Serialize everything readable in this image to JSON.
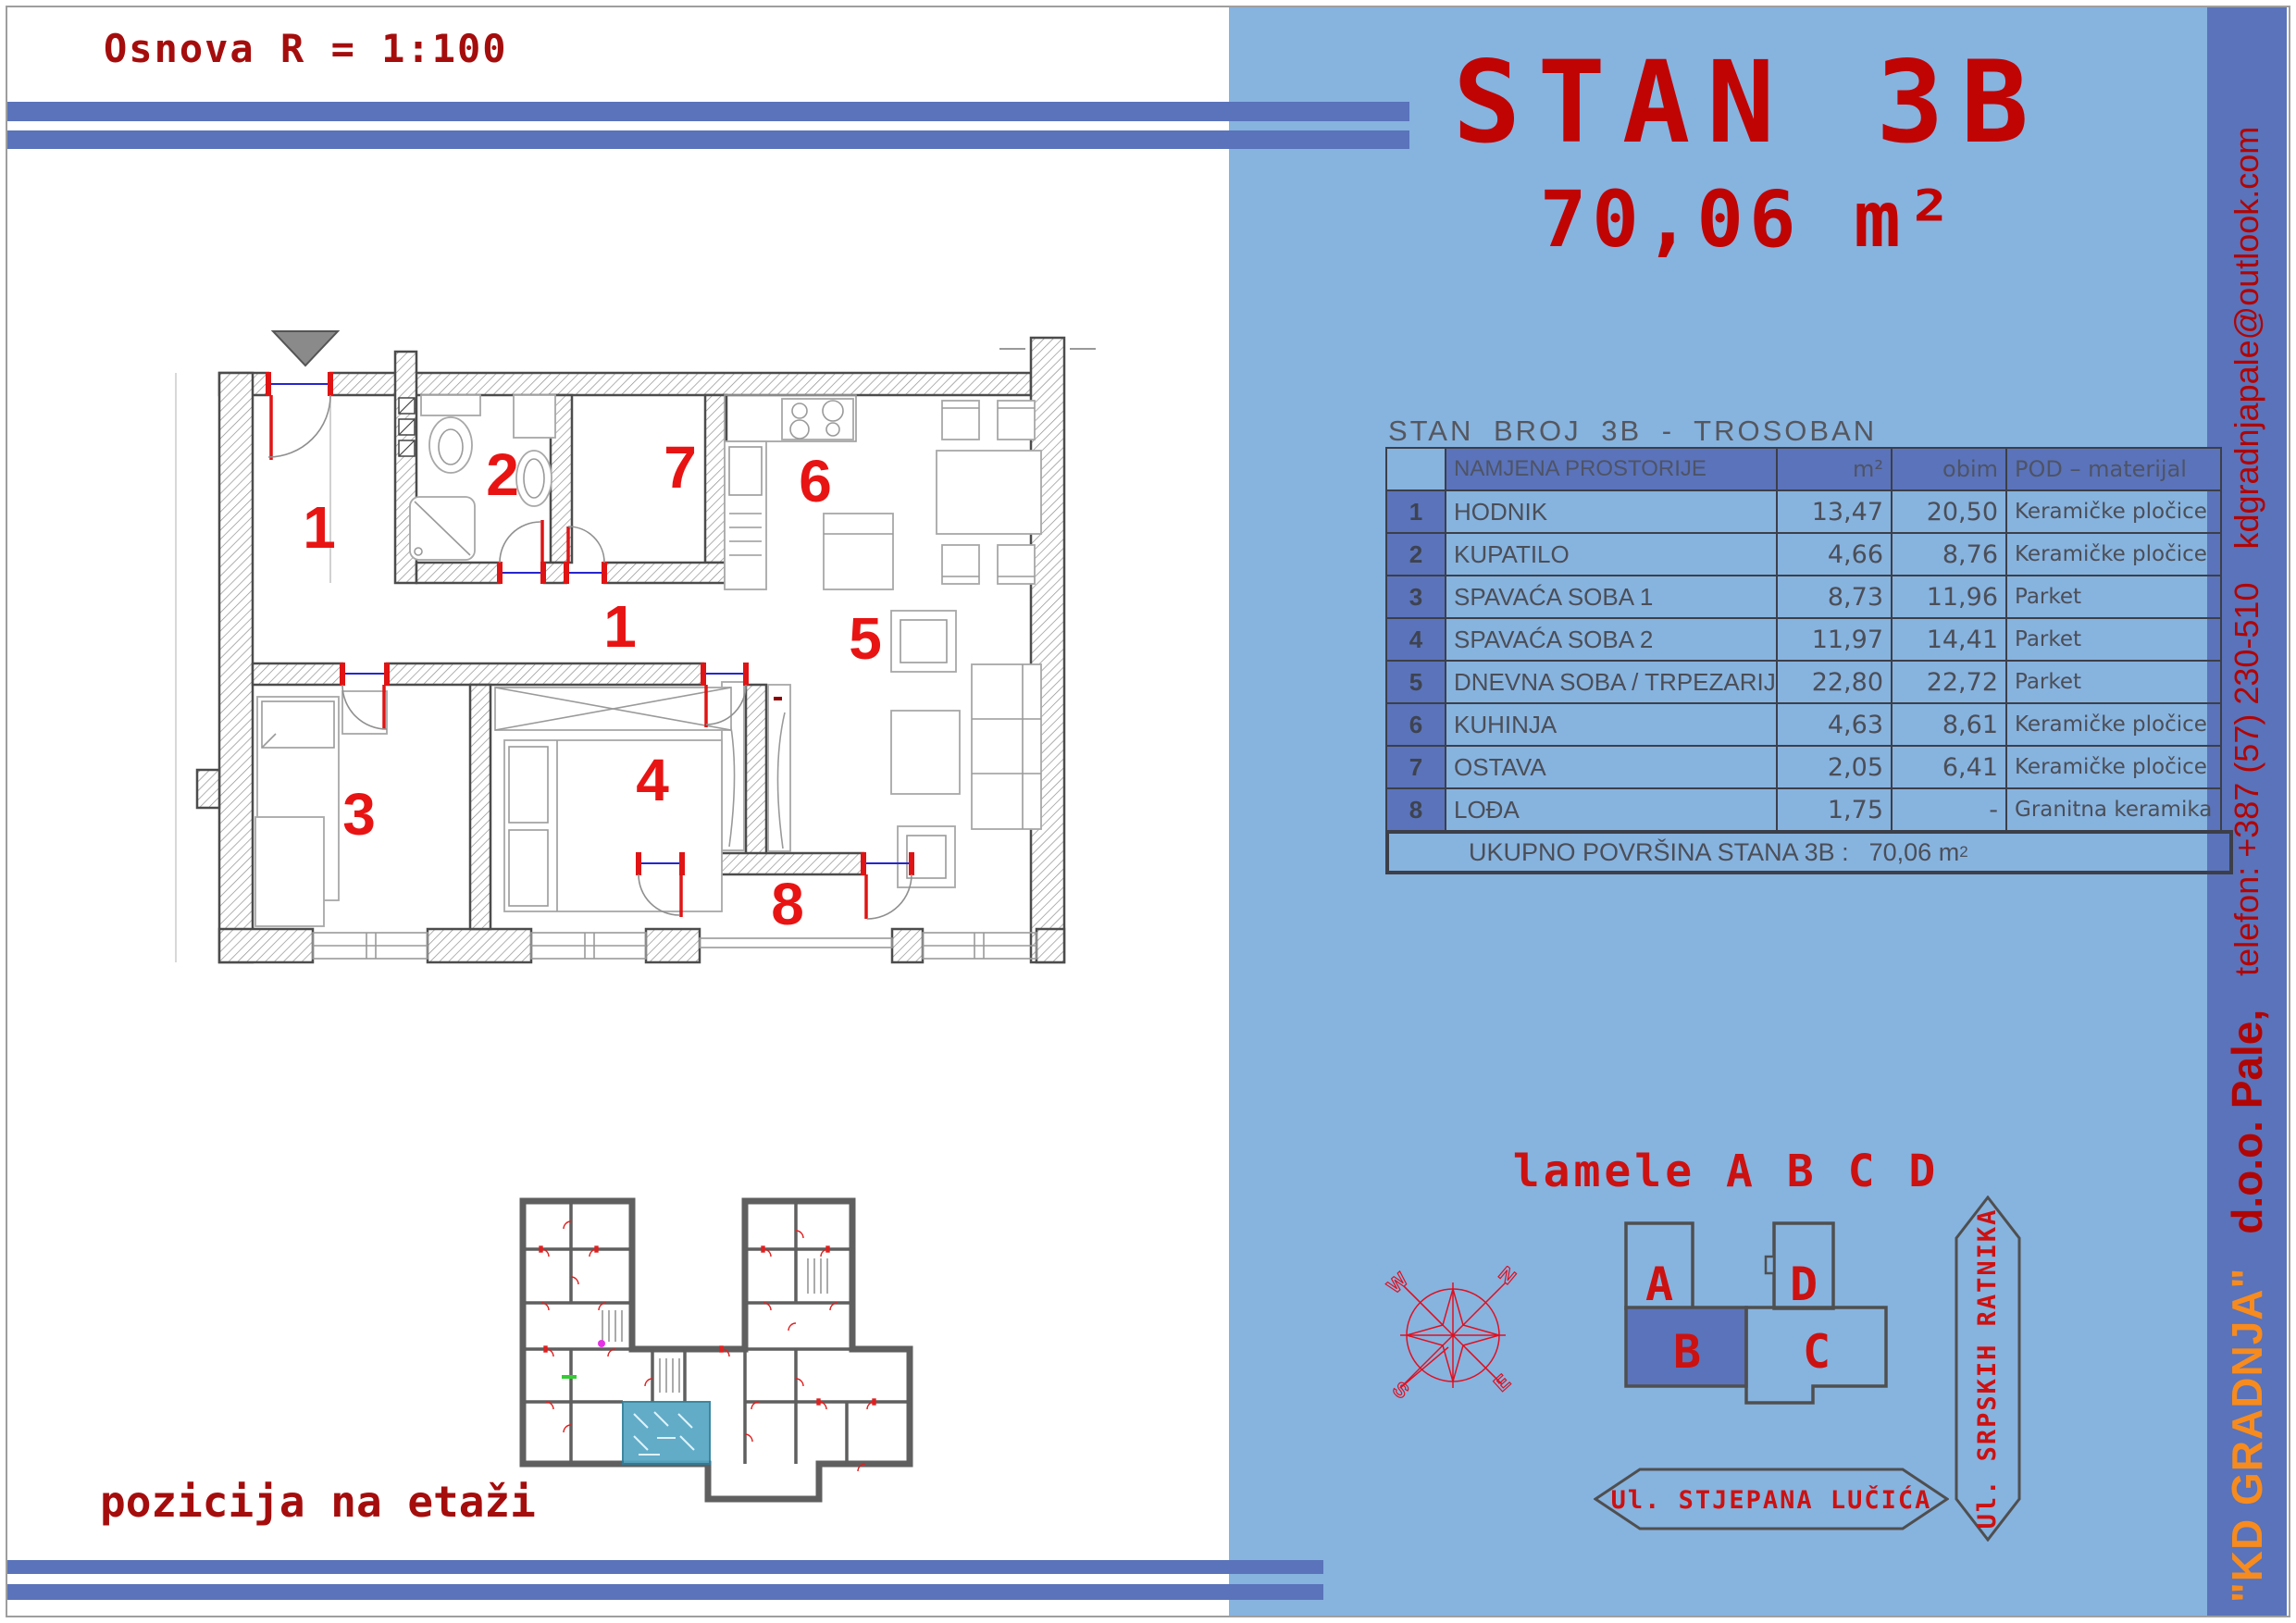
{
  "page": {
    "scale_label": "Osnova R = 1:100",
    "position_label": "pozicija na etaži"
  },
  "panel": {
    "title": "STAN 3B",
    "area": "70,06 m²",
    "table": {
      "title": "STAN BROJ 3B - TROSOBAN",
      "columns": {
        "name": "NAMJENA PROSTORIJE",
        "area": "m²",
        "perimeter": "obim",
        "floor": "POD – materijal"
      },
      "rows": [
        {
          "num": "1",
          "name": "HODNIK",
          "area": "13,47",
          "obim": "20,50",
          "pod": "Keramičke pločice"
        },
        {
          "num": "2",
          "name": "KUPATILO",
          "area": "4,66",
          "obim": "8,76",
          "pod": "Keramičke pločice"
        },
        {
          "num": "3",
          "name": "SPAVAĆA SOBA 1",
          "area": "8,73",
          "obim": "11,96",
          "pod": "Parket"
        },
        {
          "num": "4",
          "name": "SPAVAĆA SOBA 2",
          "area": "11,97",
          "obim": "14,41",
          "pod": "Parket"
        },
        {
          "num": "5",
          "name": "DNEVNA SOBA / TRPEZARIJA",
          "area": "22,80",
          "obim": "22,72",
          "pod": "Parket"
        },
        {
          "num": "6",
          "name": "KUHINJA",
          "area": "4,63",
          "obim": "8,61",
          "pod": "Keramičke pločice"
        },
        {
          "num": "7",
          "name": "OSTAVA",
          "area": "2,05",
          "obim": "6,41",
          "pod": "Keramičke pločice"
        },
        {
          "num": "8",
          "name": "LOĐA",
          "area": "1,75",
          "obim": "-",
          "pod": "Granitna keramika"
        }
      ],
      "footer_label": "UKUPNO POVRŠINA STANA  3B :",
      "footer_value": "70,06 m"
    },
    "lamele_title": "lamele A B C D",
    "blocks": {
      "a": "A",
      "b": "B",
      "c": "C",
      "d": "D"
    },
    "streets": {
      "vertical": "Ul. SRPSKIH RATNIKA",
      "horizontal": "Ul. STJEPANA LUČIĆA"
    },
    "compass": {
      "n": "N",
      "e": "E",
      "s": "S",
      "w": "W"
    }
  },
  "sidebar": {
    "company": "\"KD GRADNJA\"",
    "company2": "d.o.o.  Pale,",
    "phone": "telefon: +387 (57) 230-510",
    "email": "kdgradnjapale@outlook.com"
  },
  "floor_plan": {
    "labels": [
      "1",
      "2",
      "7",
      "6",
      "1",
      "5",
      "3",
      "4",
      "8"
    ]
  }
}
